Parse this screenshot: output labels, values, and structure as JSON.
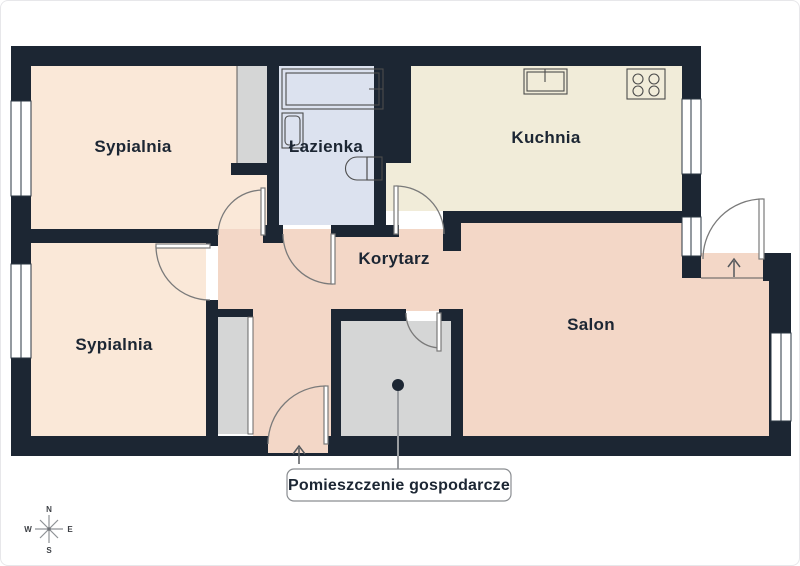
{
  "plan": {
    "rooms": {
      "bedroom_top": {
        "label": "Sypialnia"
      },
      "bedroom_bottom": {
        "label": "Sypialnia"
      },
      "bathroom": {
        "label": "Łazienka"
      },
      "kitchen": {
        "label": "Kuchnia"
      },
      "corridor": {
        "label": "Korytarz"
      },
      "living_room": {
        "label": "Salon"
      }
    },
    "callout": {
      "utility_room_label": "Pomieszczenie gospodarcze"
    },
    "compass": {
      "north": "N",
      "east": "E",
      "south": "S",
      "west": "W"
    },
    "colors": {
      "wall": "#1c2633",
      "bedroom_floor": "#fae8d8",
      "kitchen_floor": "#f1ecd9",
      "bathroom_floor": "#dce2ef",
      "living_floor": "#f3d7c7",
      "storage_floor": "#d5d6d6",
      "background": "#ffffff"
    }
  }
}
